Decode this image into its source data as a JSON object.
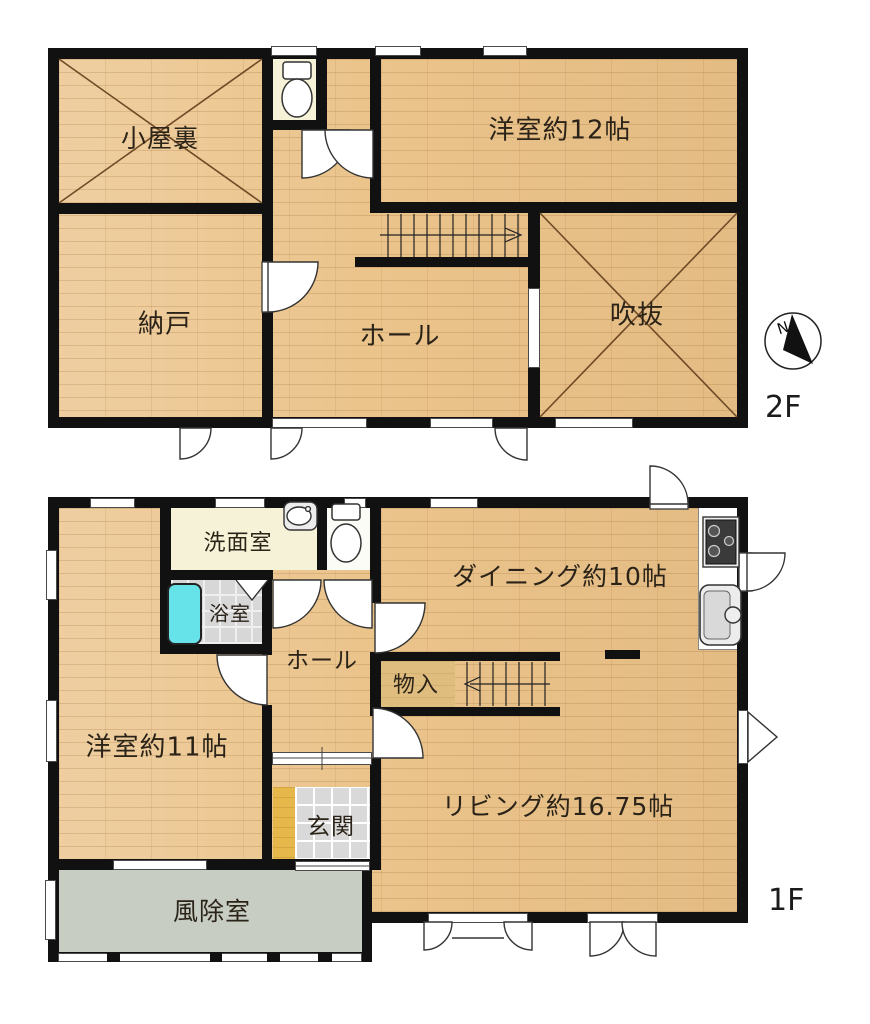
{
  "labels": {
    "f2": {
      "attic": "小屋裏",
      "yoshitsu12": "洋室約12帖",
      "nando": "納戸",
      "hall": "ホール",
      "fukinuke": "吹抜",
      "floor_tag": "2F"
    },
    "f1": {
      "senmen": "洗面室",
      "dining": "ダイニング約10帖",
      "bath": "浴室",
      "hall": "ホール",
      "monoire": "物入",
      "yoshitsu11": "洋室約11帖",
      "genkan": "玄関",
      "living": "リビング約16.75帖",
      "fujoshitsu": "風除室",
      "floor_tag": "1F"
    },
    "compass": {
      "north": "N"
    }
  },
  "colors": {
    "wall": "#111111",
    "wood_floor": "#ebc48c",
    "washroom_floor": "#f6f2d7",
    "bath_tub": "#66e2e9",
    "entry_step": "#e6b84c",
    "entry_tile": "#d9d9d9",
    "windbreak_floor": "#c7cdc3",
    "closet_floor": "#dfbd7e"
  }
}
